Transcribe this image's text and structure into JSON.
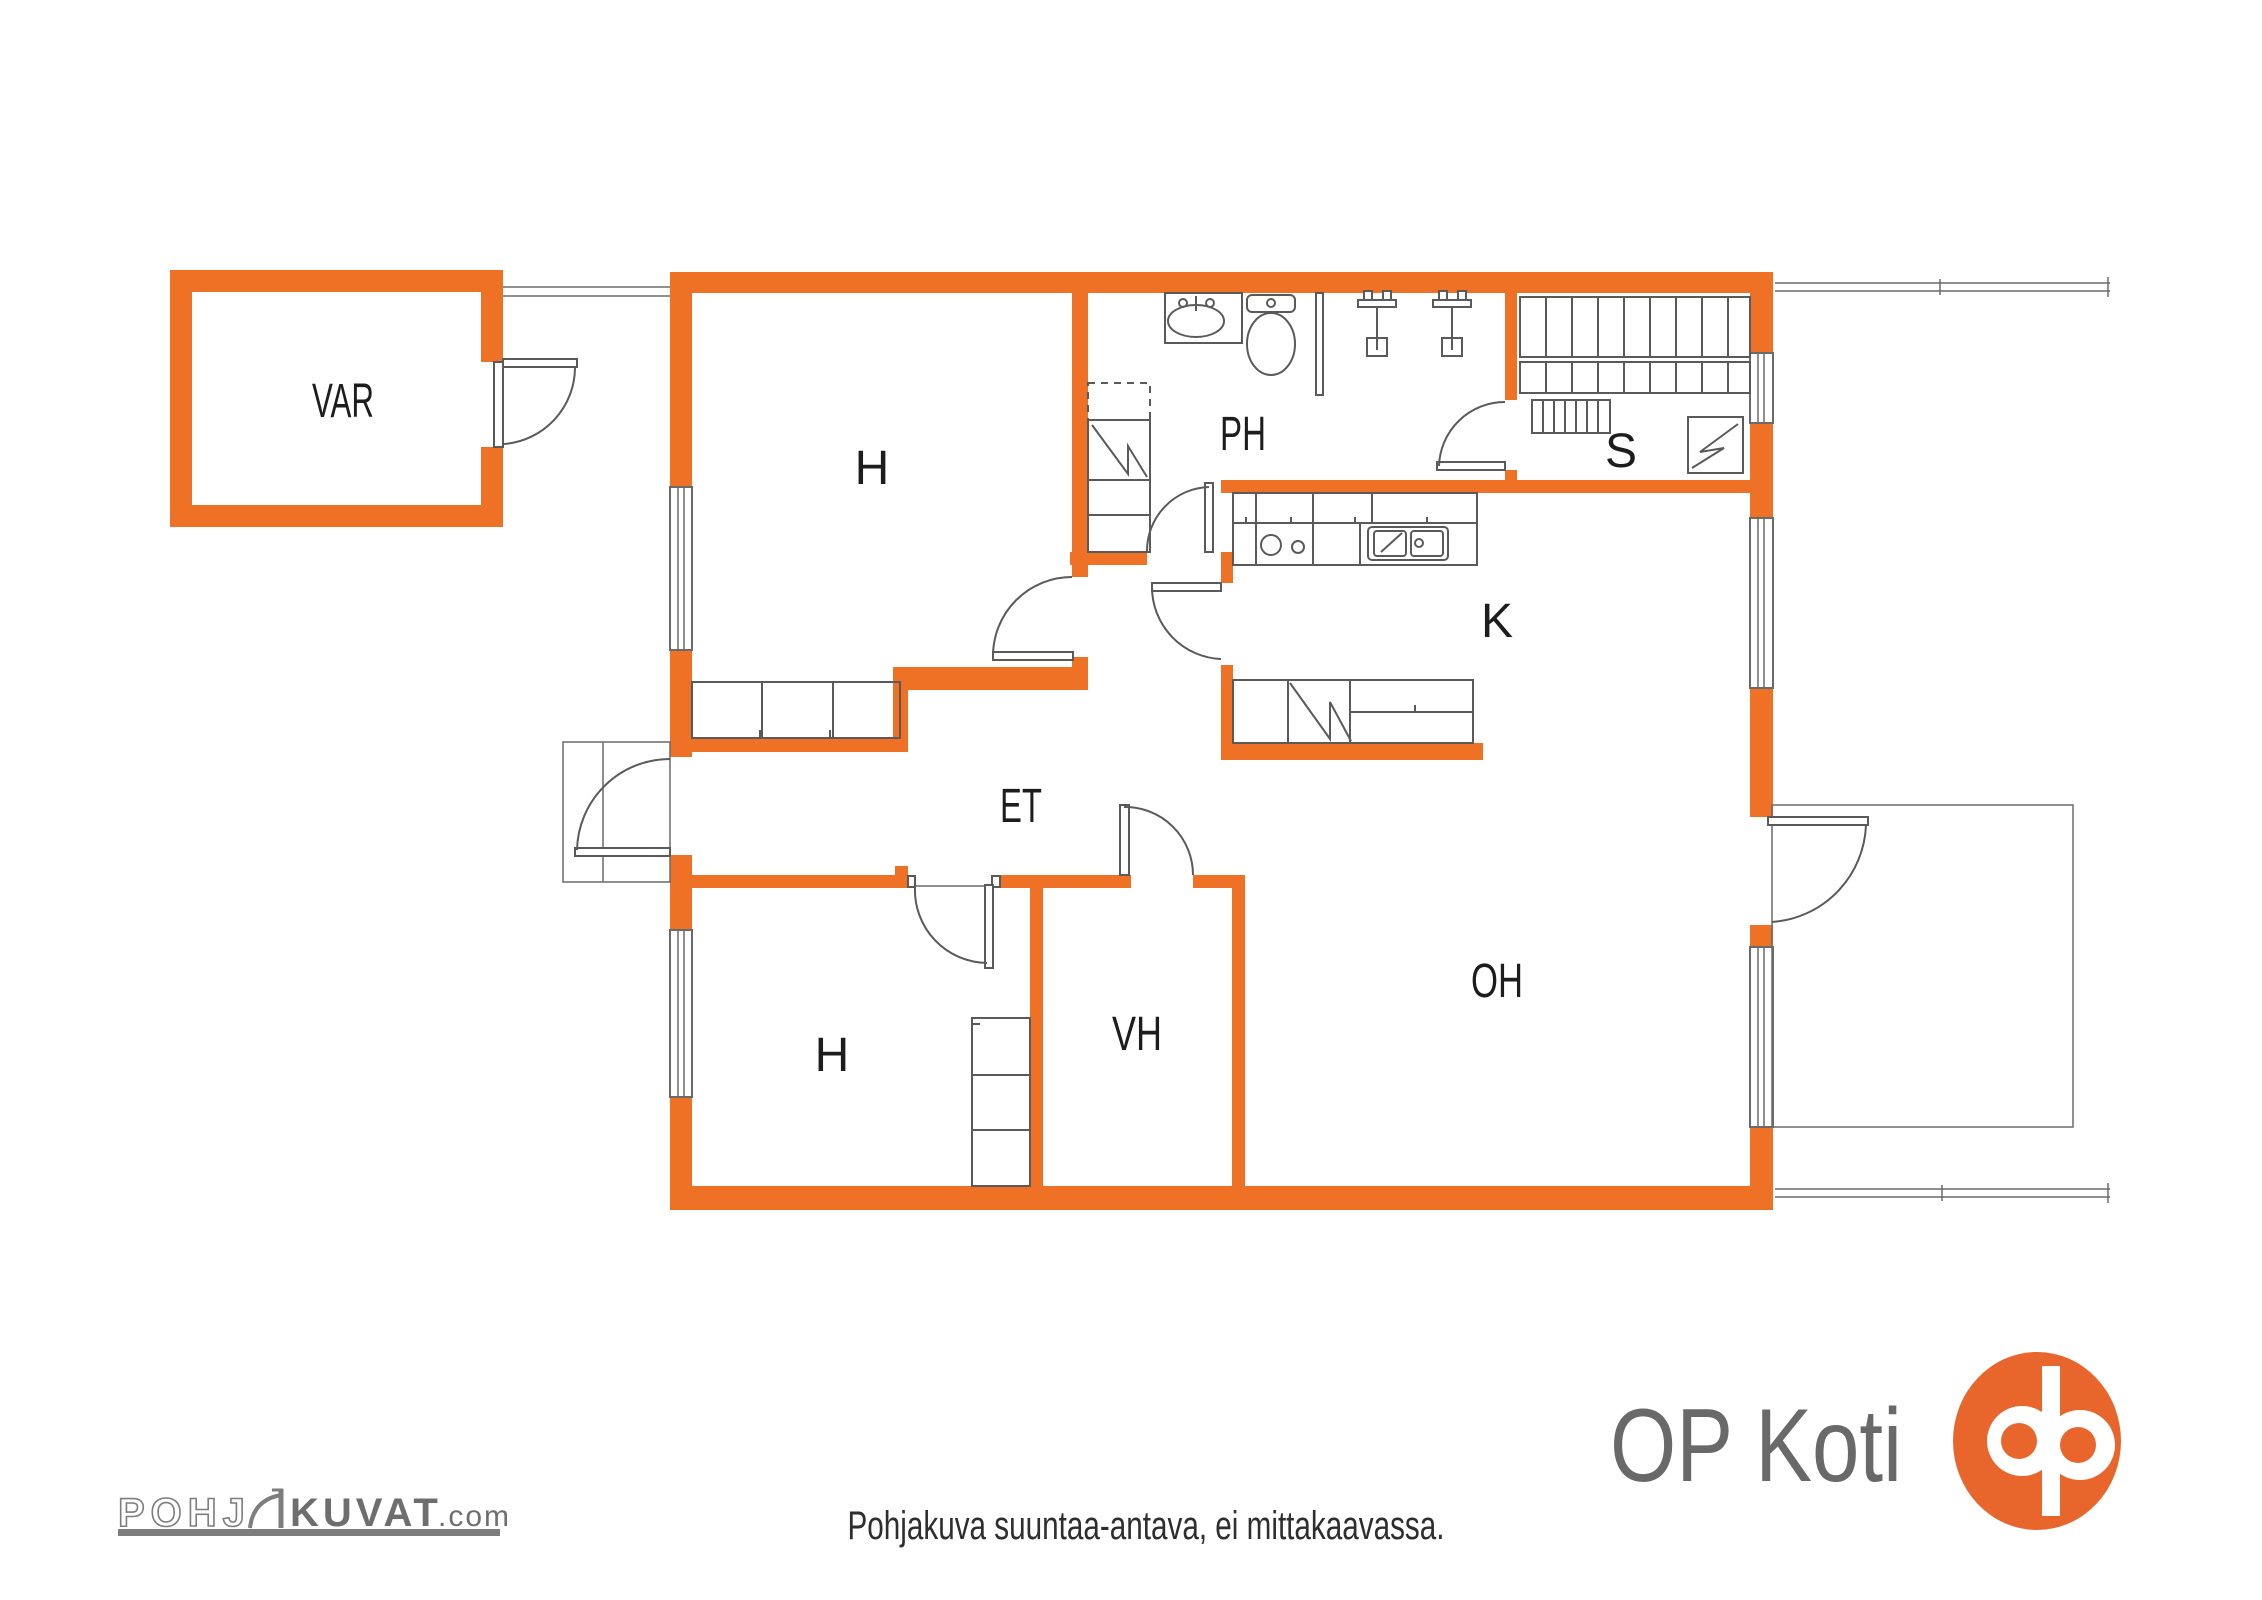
{
  "colors": {
    "wall_orange": "#ee7125",
    "logo_orange": "#e8662b",
    "line_gray": "#5a5a5a",
    "label_color": "#1d1d1d"
  },
  "floor_plan": {
    "rooms": [
      {
        "id": "var",
        "label": "VAR"
      },
      {
        "id": "h1",
        "label": "H"
      },
      {
        "id": "ph",
        "label": "PH"
      },
      {
        "id": "s",
        "label": "S"
      },
      {
        "id": "k",
        "label": "K"
      },
      {
        "id": "et",
        "label": "ET"
      },
      {
        "id": "h2",
        "label": "H"
      },
      {
        "id": "vh",
        "label": "VH"
      },
      {
        "id": "oh",
        "label": "OH"
      }
    ]
  },
  "footer": {
    "disclaimer": "Pohjakuva suuntaa-antava, ei mittakaavassa.",
    "pohjakuvat_logo": {
      "part1": "POHJ",
      "part2": "KUVAT",
      "suffix": ".com"
    },
    "op_koti": {
      "text": "OP Koti"
    }
  }
}
